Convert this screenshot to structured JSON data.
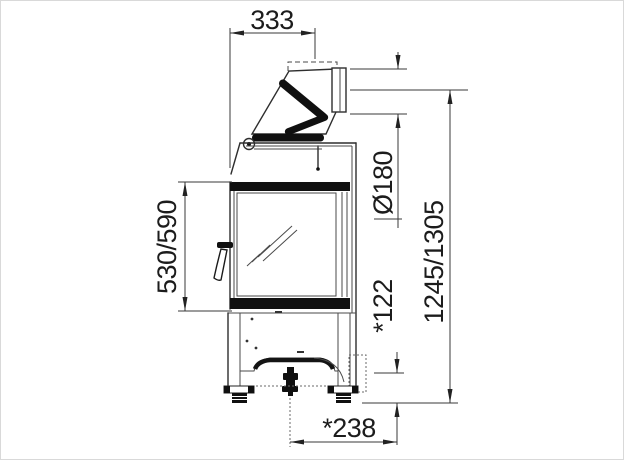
{
  "diagram": {
    "title": "Fireplace stove side elevation - dimensioned technical drawing",
    "dimensions": {
      "front_to_flue_axis": "333",
      "flue_diameter": "Ø180",
      "door_height": "530/590",
      "total_height": "1245/1305",
      "air_inlet_height": "*122",
      "air_inlet_depth": "*238"
    },
    "colors": {
      "line": "#2e2e2e",
      "black_fill": "#101010",
      "background": "#ffffff",
      "border": "#d2d2d2"
    }
  }
}
